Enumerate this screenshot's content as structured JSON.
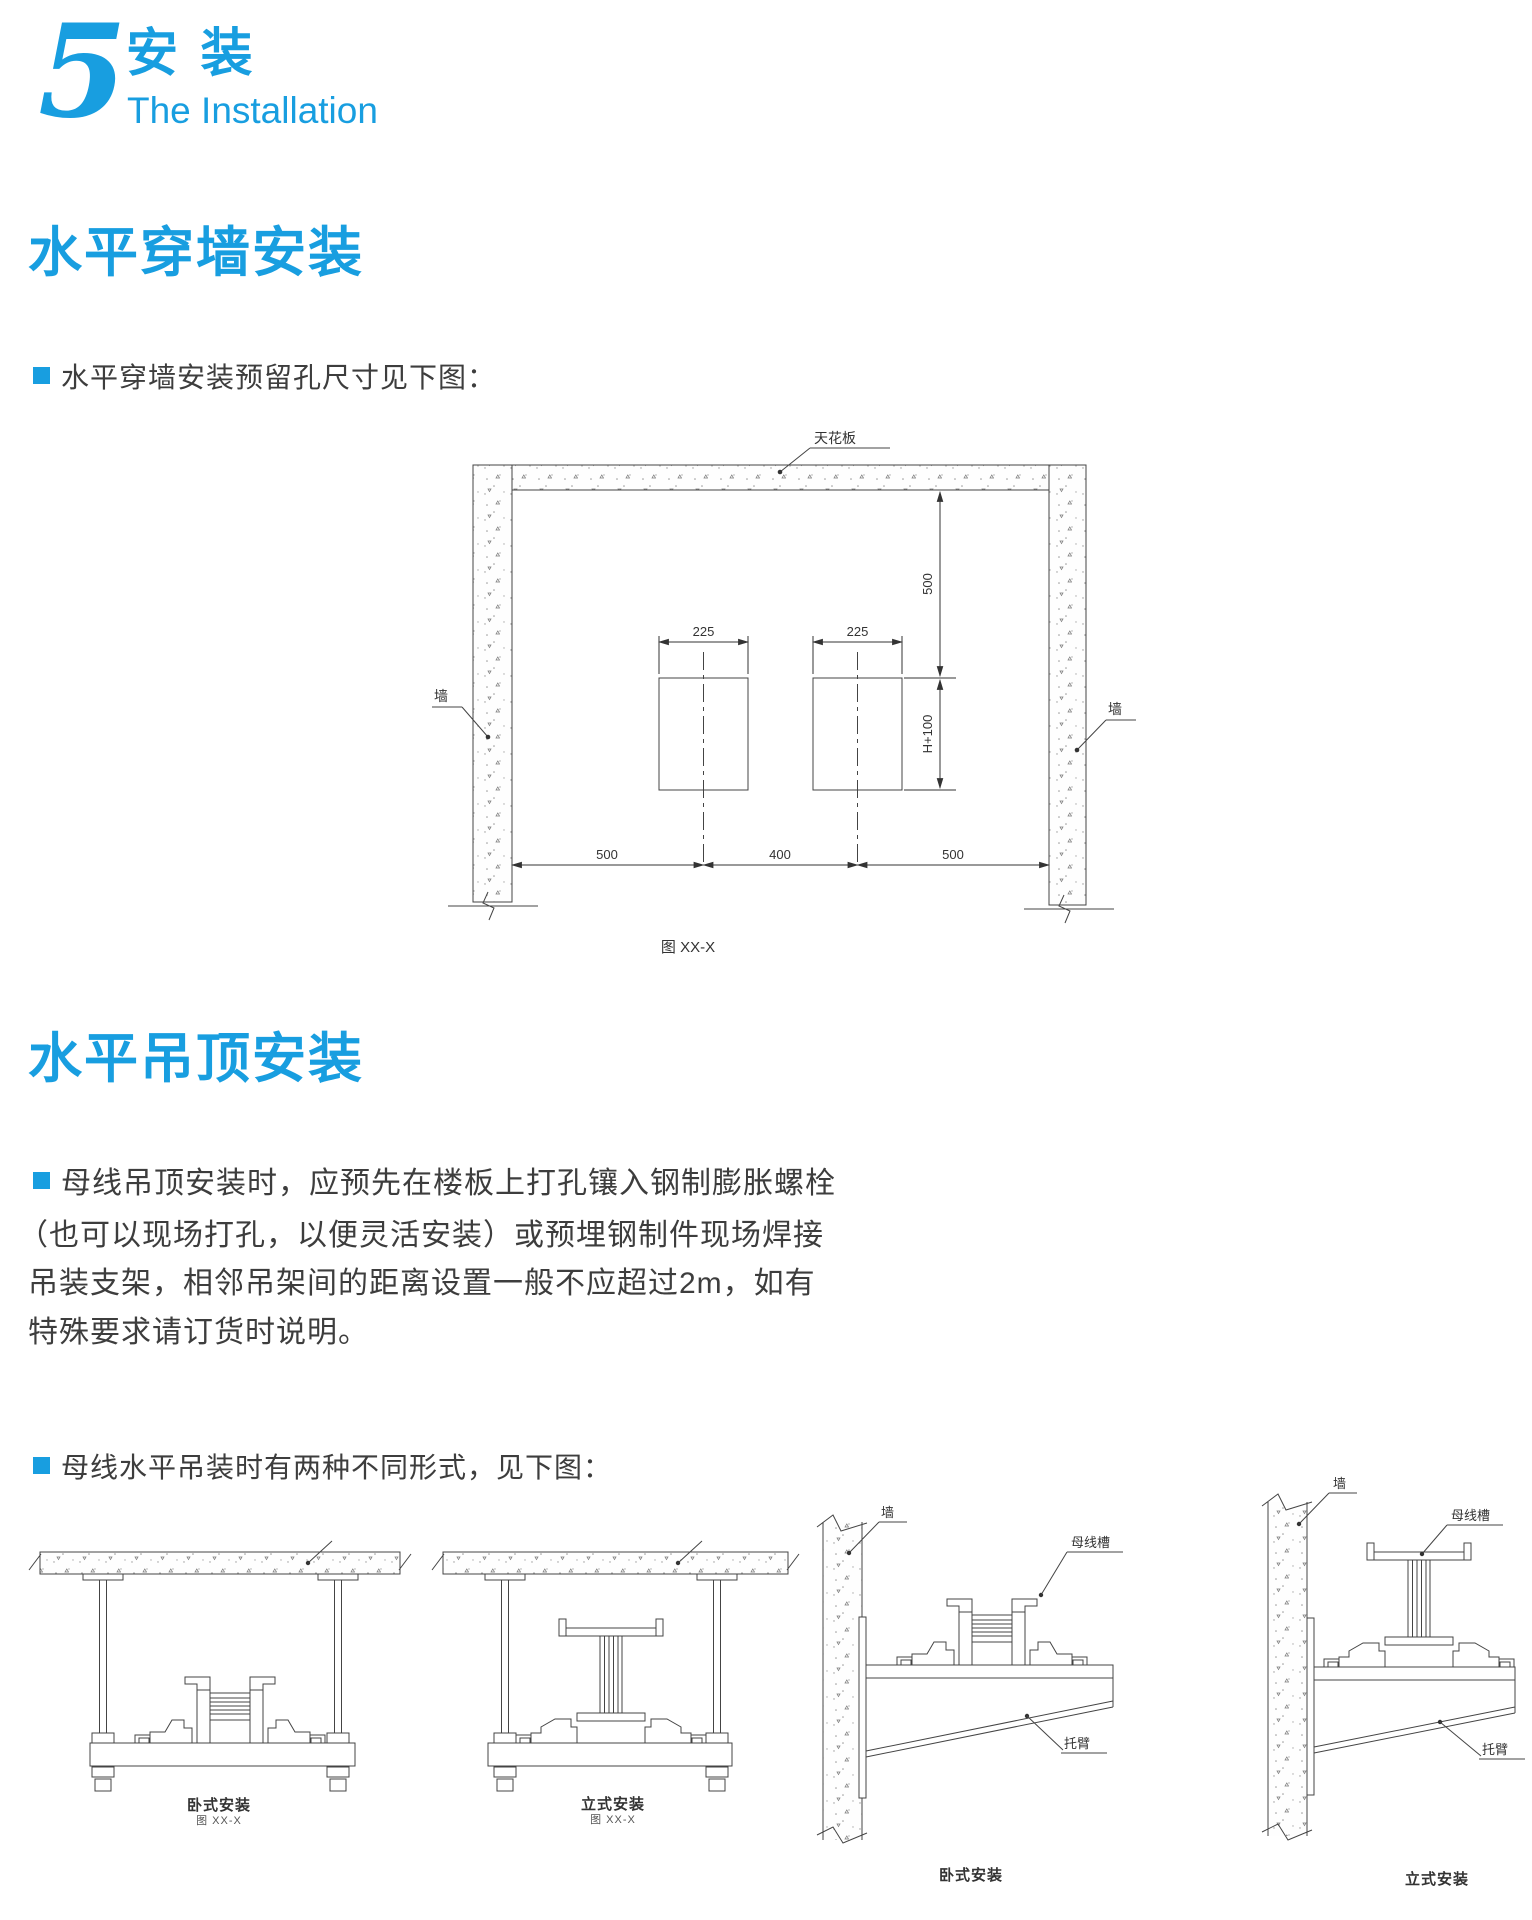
{
  "header": {
    "number": "5",
    "title_zh": "安 装",
    "title_en": "The Installation"
  },
  "colors": {
    "accent": "#189EE0",
    "text": "#3d3d3d",
    "line": "#444444"
  },
  "section1": {
    "title": "水平穿墙安装",
    "bullet": "水平穿墙安装预留孔尺寸见下图：",
    "figure": {
      "label_ceiling": "天花板",
      "label_wall_left": "墙",
      "label_wall_right": "墙",
      "dim_hole1_width": "225",
      "dim_hole2_width": "225",
      "dim_top_clearance": "500",
      "dim_hole_height": "H+100",
      "dim_left": "500",
      "dim_middle": "400",
      "dim_right": "500",
      "caption": "图 XX-X"
    }
  },
  "section2": {
    "title": "水平吊顶安装",
    "paragraph_lines": [
      "母线吊顶安装时，应预先在楼板上打孔镶入钢制膨胀螺栓",
      "（也可以现场打孔，以便灵活安装）或预埋钢制件现场焊接",
      "吊装支架，相邻吊架间的距离设置一般不应超过2m，如有",
      "特殊要求请订货时说明。"
    ],
    "bullet": "母线水平吊装时有两种不同形式，见下图：",
    "fig_hang_horizontal": {
      "caption": "卧式安装",
      "fig_no": "图 XX-X"
    },
    "fig_hang_vertical": {
      "caption": "立式安装",
      "fig_no": "图 XX-X"
    },
    "fig_bracket_horizontal": {
      "caption": "卧式安装",
      "label_wall": "墙",
      "label_duct": "母线槽",
      "label_arm": "托臂"
    },
    "fig_bracket_vertical": {
      "caption": "立式安装",
      "label_wall": "墙",
      "label_duct": "母线槽",
      "label_arm": "托臂"
    }
  }
}
